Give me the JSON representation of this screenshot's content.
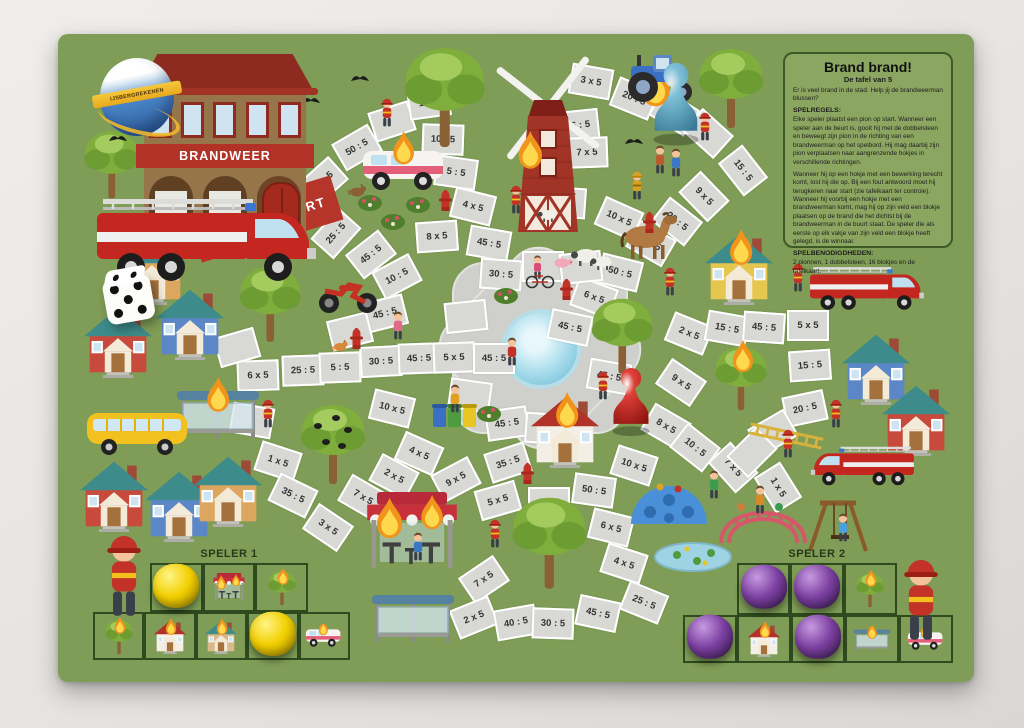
{
  "photo": {
    "surface": "#e6e4e1"
  },
  "logo": {
    "text": "IJSBERGREKENEN"
  },
  "station": {
    "sign": "BRANDWEER"
  },
  "rules": {
    "title": "Brand brand!",
    "subtitle": "De tafel van 5",
    "intro": "Er is veel brand in de stad. Help jij de brandweerman blussen?",
    "h1": "SPELREGELS:",
    "p1": "Elke speler plaatst een pion op start. Wanneer een speler aan de beurt is, gooit hij met de dobbelsteen en beweegt zijn pion in de richting van een brandweerman op het spelbord. Hij mag daarbij zijn pion verplaatsen naar aangrenzende hokjes in verschillende richtingen.",
    "p2": "Wanneer hij op een hokje met een bewerking terecht komt, lost hij die op. Bij een fout antwoord moet hij terugkeren naar start (zie tafelkaart ter controle). Wanneer hij voorbij een hokje met een brandweerman komt, mag hij op zijn veld een blokje plaatsen op de brand die het dichtst bij de brandweerman in de buurt staat. De speler die als eerste op elk vakje van zijn veld een blokje heeft gelegd, is de winnaar.",
    "h2": "SPELBENODIGDHEDEN:",
    "p3": "2 pionnen, 1 dobbelsteen, 16 blokjes en de tafelkaart."
  },
  "board": {
    "color": "#7f9d56",
    "tile_color": "#d8d8d4",
    "start": {
      "label": "START",
      "color": "#b5352a"
    },
    "tiles": [
      {
        "l": "40 : 5",
        "x": 323,
        "y": 181,
        "r": -42
      },
      {
        "l": "50 : 5",
        "x": 357,
        "y": 147,
        "r": -30
      },
      {
        "l": "",
        "x": 392,
        "y": 121,
        "r": -18
      },
      {
        "l": "1 x 5",
        "x": 429,
        "y": 102,
        "r": -8
      },
      {
        "l": "10 : 5",
        "x": 443,
        "y": 139,
        "r": 2
      },
      {
        "l": "5 : 5",
        "x": 456,
        "y": 172,
        "r": 8
      },
      {
        "l": "4 x 5",
        "x": 473,
        "y": 206,
        "r": 14
      },
      {
        "l": "8 x 5",
        "x": 437,
        "y": 236,
        "r": -4
      },
      {
        "l": "45 : 5",
        "x": 489,
        "y": 243,
        "r": 10
      },
      {
        "l": "25 : 5",
        "x": 336,
        "y": 233,
        "r": -48
      },
      {
        "l": "45 : 5",
        "x": 371,
        "y": 254,
        "r": -38
      },
      {
        "l": "10 : 5",
        "x": 397,
        "y": 276,
        "r": -28
      },
      {
        "l": "45 : 5",
        "x": 385,
        "y": 313,
        "r": -14
      },
      {
        "l": "30 : 5",
        "x": 501,
        "y": 274,
        "r": 4
      },
      {
        "l": "45 : 5",
        "x": 578,
        "y": 125,
        "r": -6
      },
      {
        "l": "7 x 5",
        "x": 587,
        "y": 152,
        "r": -2
      },
      {
        "l": "5 : 5",
        "x": 565,
        "y": 202,
        "r": 4
      },
      {
        "l": "3 x 5",
        "x": 591,
        "y": 81,
        "r": 10
      },
      {
        "l": "20 : 5",
        "x": 634,
        "y": 98,
        "r": 22
      },
      {
        "l": "",
        "x": 674,
        "y": 112,
        "r": 32
      },
      {
        "l": "",
        "x": 708,
        "y": 133,
        "r": 42
      },
      {
        "l": "15 : 5",
        "x": 743,
        "y": 170,
        "r": 52
      },
      {
        "l": "9 x 5",
        "x": 704,
        "y": 196,
        "r": 46
      },
      {
        "l": "20 : 5",
        "x": 677,
        "y": 221,
        "r": 38
      },
      {
        "l": "8 x 5",
        "x": 651,
        "y": 243,
        "r": 30
      },
      {
        "l": "10 x 5",
        "x": 619,
        "y": 218,
        "r": 24
      },
      {
        "l": "50 : 5",
        "x": 620,
        "y": 272,
        "r": 14
      },
      {
        "l": "6 x 5",
        "x": 594,
        "y": 297,
        "r": 20
      },
      {
        "l": "45 : 5",
        "x": 570,
        "y": 327,
        "r": 12
      },
      {
        "l": "6 x 5",
        "x": 258,
        "y": 375,
        "r": -2
      },
      {
        "l": "25 : 5",
        "x": 303,
        "y": 370,
        "r": -2
      },
      {
        "l": "5 : 5",
        "x": 340,
        "y": 367,
        "r": -2
      },
      {
        "l": "30 : 5",
        "x": 381,
        "y": 361,
        "r": -3
      },
      {
        "l": "45 : 5",
        "x": 419,
        "y": 358,
        "r": -2
      },
      {
        "l": "5 x 5",
        "x": 454,
        "y": 357,
        "r": -2
      },
      {
        "l": "45 : 5",
        "x": 494,
        "y": 358,
        "r": 0
      },
      {
        "l": "",
        "x": 237,
        "y": 347,
        "r": -16
      },
      {
        "l": "",
        "x": 350,
        "y": 331,
        "r": -14
      },
      {
        "l": "1 x 5",
        "x": 278,
        "y": 461,
        "r": 18
      },
      {
        "l": "",
        "x": 252,
        "y": 420,
        "r": 10
      },
      {
        "l": "35 : 5",
        "x": 293,
        "y": 495,
        "r": 26
      },
      {
        "l": "3 x 5",
        "x": 328,
        "y": 527,
        "r": 34
      },
      {
        "l": "7 x 5",
        "x": 363,
        "y": 497,
        "r": 30
      },
      {
        "l": "10 x 5",
        "x": 392,
        "y": 408,
        "r": 14
      },
      {
        "l": "4 x 5",
        "x": 419,
        "y": 453,
        "r": 24
      },
      {
        "l": "2 x 5",
        "x": 394,
        "y": 476,
        "r": 28
      },
      {
        "l": "7 x 5",
        "x": 484,
        "y": 579,
        "r": -34
      },
      {
        "l": "2 x 5",
        "x": 474,
        "y": 617,
        "r": -22
      },
      {
        "l": "40 : 5",
        "x": 516,
        "y": 622,
        "r": -10
      },
      {
        "l": "30 : 5",
        "x": 553,
        "y": 623,
        "r": 2
      },
      {
        "l": "45 : 5",
        "x": 598,
        "y": 613,
        "r": 12
      },
      {
        "l": "25 : 5",
        "x": 644,
        "y": 602,
        "r": 22
      },
      {
        "l": "35 : 5",
        "x": 508,
        "y": 462,
        "r": -18
      },
      {
        "l": "9 x 5",
        "x": 456,
        "y": 479,
        "r": -28
      },
      {
        "l": "5 x 5",
        "x": 498,
        "y": 500,
        "r": -16
      },
      {
        "l": "3 x 5",
        "x": 549,
        "y": 502,
        "r": 0
      },
      {
        "l": "50 : 5",
        "x": 594,
        "y": 490,
        "r": 8
      },
      {
        "l": "10 x 5",
        "x": 634,
        "y": 465,
        "r": 18
      },
      {
        "l": "6 x 5",
        "x": 611,
        "y": 527,
        "r": 14
      },
      {
        "l": "4 x 5",
        "x": 624,
        "y": 563,
        "r": 18
      },
      {
        "l": "45 : 5",
        "x": 507,
        "y": 423,
        "r": -8
      },
      {
        "l": "45 : 5",
        "x": 609,
        "y": 376,
        "r": 10
      },
      {
        "l": "9 x 5",
        "x": 681,
        "y": 382,
        "r": 34
      },
      {
        "l": "8 x 5",
        "x": 666,
        "y": 426,
        "r": 30
      },
      {
        "l": "10 : 5",
        "x": 695,
        "y": 447,
        "r": 38
      },
      {
        "l": "7 x 5",
        "x": 733,
        "y": 467,
        "r": 48
      },
      {
        "l": "1 x 5",
        "x": 778,
        "y": 487,
        "r": 58
      },
      {
        "l": "2 x 5",
        "x": 689,
        "y": 333,
        "r": 22
      },
      {
        "l": "15 : 5",
        "x": 727,
        "y": 328,
        "r": 10
      },
      {
        "l": "45 : 5",
        "x": 764,
        "y": 327,
        "r": 4
      },
      {
        "l": "5 x 5",
        "x": 808,
        "y": 325,
        "r": 0
      },
      {
        "l": "15 : 5",
        "x": 810,
        "y": 365,
        "r": -4
      },
      {
        "l": "20 : 5",
        "x": 805,
        "y": 408,
        "r": -12
      },
      {
        "l": "",
        "x": 773,
        "y": 432,
        "r": -30
      },
      {
        "l": "",
        "x": 752,
        "y": 452,
        "r": -45
      },
      {
        "l": "",
        "x": 543,
        "y": 266,
        "r": 0
      },
      {
        "l": "",
        "x": 581,
        "y": 267,
        "r": -6
      },
      {
        "l": "",
        "x": 466,
        "y": 316,
        "r": -6
      },
      {
        "l": "",
        "x": 470,
        "y": 395,
        "r": 8
      },
      {
        "l": "",
        "x": 546,
        "y": 428,
        "r": 4
      }
    ]
  },
  "players": {
    "one": {
      "label": "SPELER 1",
      "block_color": "#f2cf00",
      "top": [
        {
          "i": "block"
        },
        {
          "i": "shop"
        },
        {
          "i": "tree"
        }
      ],
      "bottom": [
        {
          "i": "tree"
        },
        {
          "i": "house"
        },
        {
          "i": "school"
        },
        {
          "i": "block"
        },
        {
          "i": "van"
        }
      ]
    },
    "two": {
      "label": "SPELER 2",
      "block_color": "#7b3fa0",
      "top": [
        {
          "i": "block"
        },
        {
          "i": "shop",
          "block": true
        },
        {
          "i": "tree"
        }
      ],
      "bottom": [
        {
          "i": "block"
        },
        {
          "i": "house"
        },
        {
          "i": "block"
        },
        {
          "i": "busstop"
        },
        {
          "i": "van"
        }
      ]
    }
  },
  "pieces": {
    "pawn_blue": {
      "x": 676,
      "y": 103,
      "light": "#7fc2d8",
      "dark": "#3a7a96"
    },
    "pawn_red": {
      "x": 631,
      "y": 401,
      "light": "#e04038",
      "dark": "#8e1410"
    },
    "die": {
      "x": 128,
      "y": 296,
      "top_pips": 2,
      "front_pips": 5
    }
  },
  "decorations": [
    {
      "t": "tree",
      "x": 445,
      "y": 96,
      "s": 1.25
    },
    {
      "t": "tree",
      "x": 112,
      "y": 164,
      "s": 0.85
    },
    {
      "t": "tree",
      "x": 270,
      "y": 303,
      "s": 0.95
    },
    {
      "t": "tree",
      "x": 333,
      "y": 443,
      "s": 1.0,
      "crows": true
    },
    {
      "t": "tree",
      "x": 549,
      "y": 541,
      "s": 1.15
    },
    {
      "t": "tree",
      "x": 622,
      "y": 335,
      "s": 0.95
    },
    {
      "t": "tree",
      "x": 731,
      "y": 87,
      "s": 1.0
    },
    {
      "t": "tree",
      "x": 741,
      "y": 377,
      "s": 0.8,
      "fire": true
    },
    {
      "t": "windmill",
      "x": 560,
      "y": 148
    },
    {
      "t": "flame",
      "x": 530,
      "y": 152,
      "s": 1.3
    },
    {
      "t": "flame",
      "x": 656,
      "y": 86,
      "s": 1.6
    },
    {
      "t": "house",
      "x": 152,
      "y": 267,
      "wall": "#dca65f"
    },
    {
      "t": "house",
      "x": 118,
      "y": 340,
      "wall": "#c84a3c"
    },
    {
      "t": "house",
      "x": 190,
      "y": 322,
      "wall": "#5b87c7"
    },
    {
      "t": "house",
      "x": 114,
      "y": 494,
      "wall": "#c84a3c"
    },
    {
      "t": "house",
      "x": 179,
      "y": 504,
      "wall": "#5b87c7"
    },
    {
      "t": "house",
      "x": 228,
      "y": 489,
      "wall": "#dca65f"
    },
    {
      "t": "house",
      "x": 739,
      "y": 267,
      "wall": "#e5c64f",
      "fire": true
    },
    {
      "t": "house",
      "x": 876,
      "y": 367,
      "wall": "#5b87c7"
    },
    {
      "t": "house",
      "x": 916,
      "y": 418,
      "wall": "#c84a3c"
    },
    {
      "t": "house",
      "x": 565,
      "y": 430,
      "wall": "#f3efe6",
      "roof": "#b03228",
      "fire": true,
      "z": 5
    },
    {
      "t": "shop",
      "x": 412,
      "y": 533,
      "s": 1.4,
      "fire": true
    },
    {
      "t": "shelter",
      "x": 218,
      "y": 412,
      "fire": true
    },
    {
      "t": "shelter",
      "x": 413,
      "y": 616
    },
    {
      "t": "bus",
      "x": 139,
      "y": 431
    },
    {
      "t": "van",
      "x": 405,
      "y": 167,
      "fire": true
    },
    {
      "t": "firetruck",
      "x": 205,
      "y": 240,
      "z": 5
    },
    {
      "t": "firetruck",
      "x": 866,
      "y": 288,
      "s": 0.52
    },
    {
      "t": "firetruck",
      "x": 863,
      "y": 466,
      "s": 0.47,
      "flip": true
    },
    {
      "t": "tractor",
      "x": 660,
      "y": 78
    },
    {
      "t": "moto",
      "x": 348,
      "y": 294
    },
    {
      "t": "horse",
      "x": 649,
      "y": 237
    },
    {
      "t": "sheep",
      "x": 584,
      "y": 256
    },
    {
      "t": "sheep",
      "x": 601,
      "y": 262,
      "s": 0.8
    },
    {
      "t": "sheep",
      "x": 547,
      "y": 215,
      "s": 0.7
    },
    {
      "t": "pig",
      "x": 563,
      "y": 262,
      "s": 0.8
    },
    {
      "t": "dome",
      "x": 669,
      "y": 501
    },
    {
      "t": "monkeybars",
      "x": 763,
      "y": 519
    },
    {
      "t": "swing",
      "x": 838,
      "y": 524
    },
    {
      "t": "bins",
      "x": 455,
      "y": 414
    },
    {
      "t": "pondfrogs",
      "x": 693,
      "y": 557
    },
    {
      "t": "ladder",
      "x": 786,
      "y": 436,
      "r": 12
    },
    {
      "t": "hydrant",
      "x": 356,
      "y": 338
    },
    {
      "t": "hydrant",
      "x": 445,
      "y": 200
    },
    {
      "t": "hydrant",
      "x": 649,
      "y": 222
    },
    {
      "t": "hydrant",
      "x": 527,
      "y": 473
    },
    {
      "t": "hydrant",
      "x": 566,
      "y": 289
    },
    {
      "t": "bird",
      "x": 360,
      "y": 78
    },
    {
      "t": "bird",
      "x": 311,
      "y": 100
    },
    {
      "t": "bird",
      "x": 634,
      "y": 141
    },
    {
      "t": "bird",
      "x": 118,
      "y": 138
    },
    {
      "t": "bush",
      "x": 370,
      "y": 201
    },
    {
      "t": "bush",
      "x": 418,
      "y": 203
    },
    {
      "t": "bush",
      "x": 393,
      "y": 220
    },
    {
      "t": "bush",
      "x": 506,
      "y": 294
    },
    {
      "t": "bush",
      "x": 489,
      "y": 412
    },
    {
      "t": "ff",
      "x": 387,
      "y": 113,
      "z": 5
    },
    {
      "t": "ff",
      "x": 705,
      "y": 127,
      "z": 5
    },
    {
      "t": "ff",
      "x": 268,
      "y": 414
    },
    {
      "t": "ff",
      "x": 495,
      "y": 534
    },
    {
      "t": "ff",
      "x": 670,
      "y": 282
    },
    {
      "t": "ff",
      "x": 603,
      "y": 386,
      "z": 5
    },
    {
      "t": "ff",
      "x": 798,
      "y": 278
    },
    {
      "t": "ff",
      "x": 836,
      "y": 414,
      "z": 5
    },
    {
      "t": "ff",
      "x": 788,
      "y": 444,
      "z": 5
    },
    {
      "t": "ff",
      "x": 516,
      "y": 200
    },
    {
      "t": "ffy",
      "x": 637,
      "y": 186
    },
    {
      "t": "kid",
      "x": 398,
      "y": 326,
      "c": "#e06a8a",
      "z": 5
    },
    {
      "t": "kid",
      "x": 512,
      "y": 352,
      "c": "#c23227",
      "z": 5
    },
    {
      "t": "kid",
      "x": 660,
      "y": 160,
      "c": "#b85c2e"
    },
    {
      "t": "kid",
      "x": 676,
      "y": 163,
      "c": "#3a77c4"
    },
    {
      "t": "kid",
      "x": 714,
      "y": 485,
      "c": "#3a9c4f"
    },
    {
      "t": "kid",
      "x": 455,
      "y": 399,
      "c": "#e0a020"
    },
    {
      "t": "kid",
      "x": 418,
      "y": 547,
      "c": "#3a77c4"
    },
    {
      "t": "kid",
      "x": 760,
      "y": 500,
      "c": "#d88a2a"
    },
    {
      "t": "kid",
      "x": 843,
      "y": 528,
      "c": "#4aa0d8"
    },
    {
      "t": "bike",
      "x": 540,
      "y": 272,
      "z": 5
    },
    {
      "t": "cat",
      "x": 340,
      "y": 345
    },
    {
      "t": "dog",
      "x": 357,
      "y": 190
    },
    {
      "t": "ffbig",
      "x": 124,
      "y": 577,
      "z": 5
    },
    {
      "t": "ffbig",
      "x": 921,
      "y": 601,
      "z": 5
    }
  ]
}
